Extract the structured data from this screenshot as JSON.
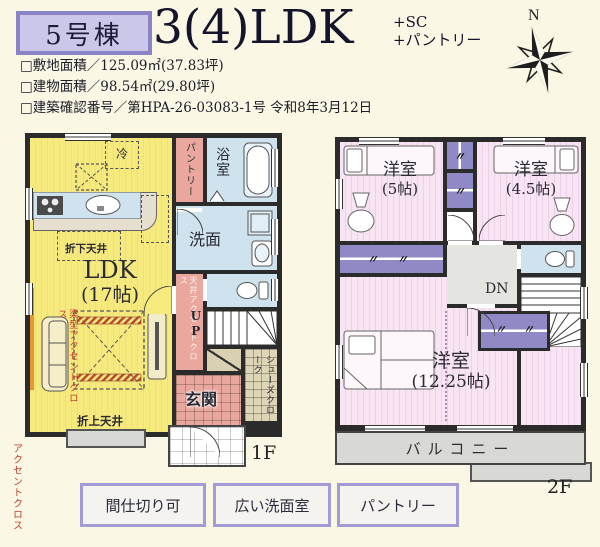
{
  "header": {
    "badge": "5号棟",
    "title": "3(4)LDK",
    "suffix1": "+SC",
    "suffix2": "+パントリー",
    "specs": [
      "□敷地面積／125.09㎡(37.83坪)",
      "□建物面積／98.54㎡(29.80坪)",
      "□建築確認番号／第HPA-26-03083-1号 令和8年3月12日"
    ],
    "compass": "N"
  },
  "floor1": {
    "label": "1F",
    "ldk": "LDK",
    "ldk_size": "(17帖)",
    "fridge": "冷",
    "ceiling_down": "折下天井",
    "ceiling_up": "折上天井",
    "accent_cloth": "アクセントクロス",
    "beam_accent": "梁型アクセントクロス",
    "ceiling_accent": "天井アクセントクロス",
    "pantry": "パントリー",
    "bath": "浴室",
    "wash": "洗面",
    "up": "UP",
    "entrance": "玄関",
    "shoes_closet": "シューズクローク"
  },
  "floor2": {
    "label": "2F",
    "room1": "洋室",
    "room1_size": "(5帖)",
    "room2": "洋室",
    "room2_size": "(4.5帖)",
    "room3": "洋室",
    "room3_size": "(12.25帖)",
    "down": "DN",
    "balcony": "バルコニー",
    "closet_mark": "〃"
  },
  "features": [
    "間仕切り可",
    "広い洗面室",
    "パントリー"
  ],
  "colors": {
    "accent_purple": "#8a84c6",
    "ldk_yellow": "#f6e97c",
    "room_pink": "#f7e2f1",
    "wet_blue": "#cfe3ef",
    "hall_salmon": "#e9a79d",
    "closet_purple": "#8f8ac5",
    "balcony_gray": "#d8d8d4",
    "wall": "#2b2b2b",
    "accent_text_red": "#c4402e"
  }
}
